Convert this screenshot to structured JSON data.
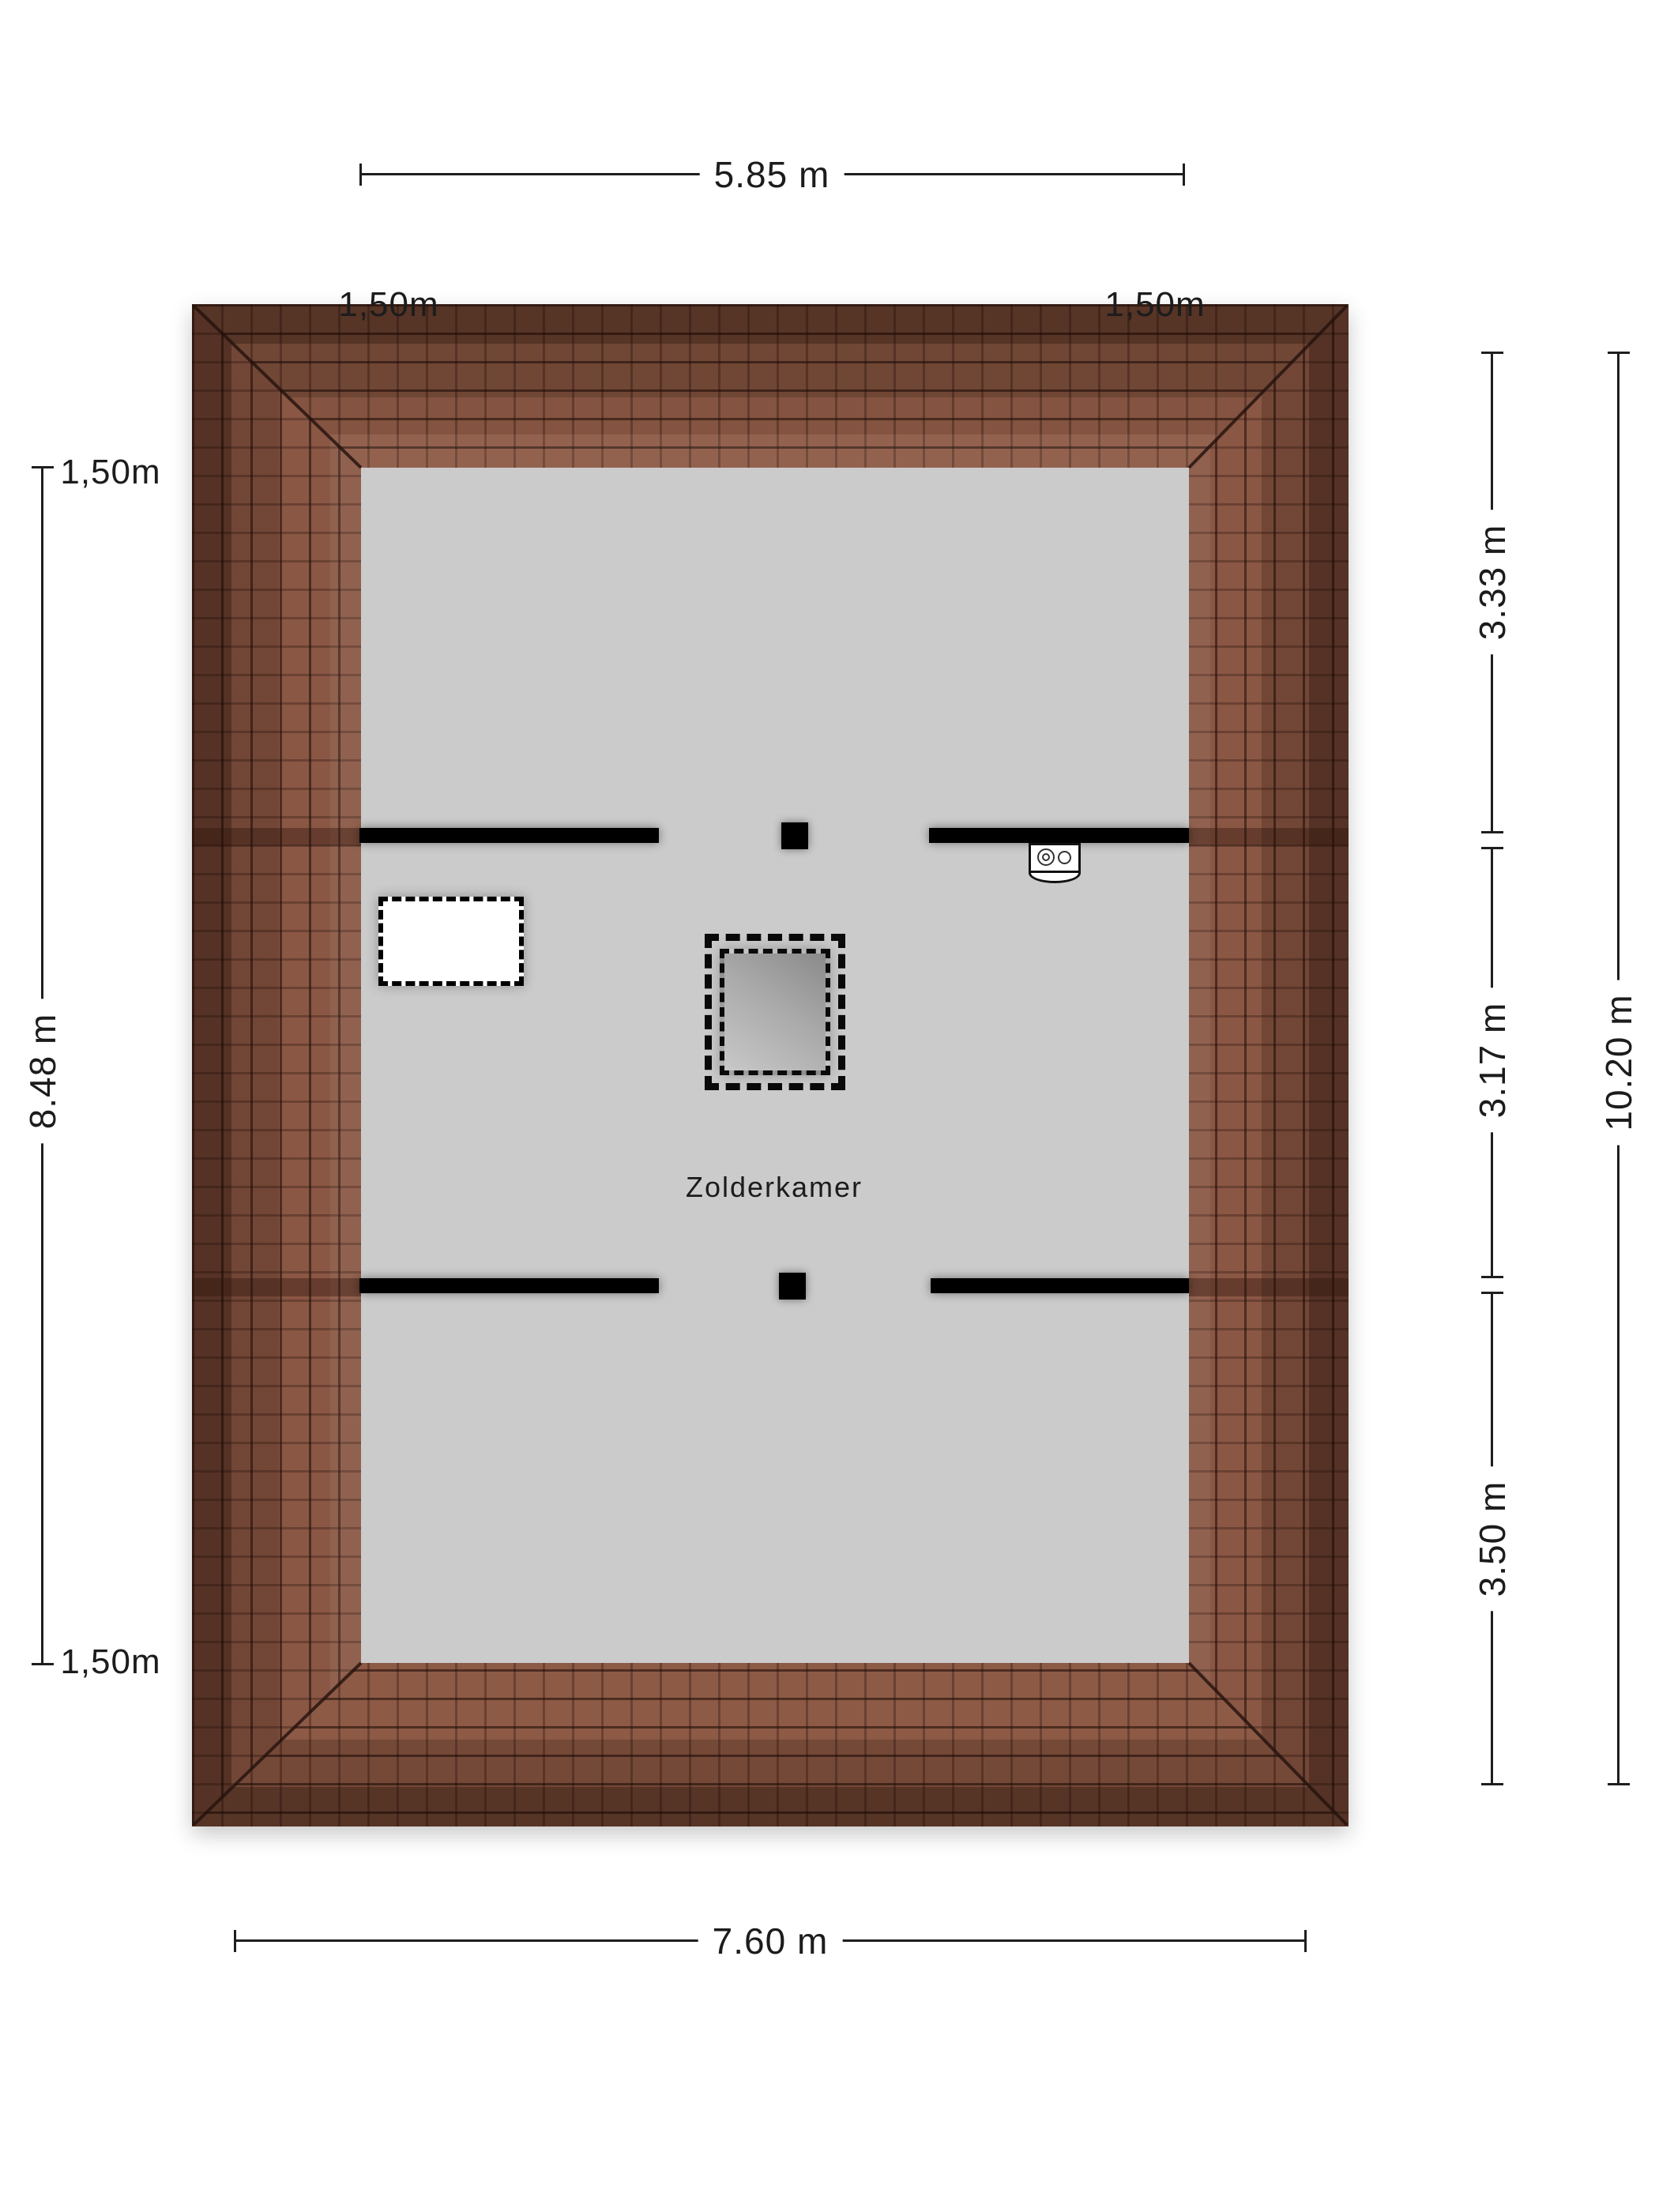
{
  "plan": {
    "type": "attic-floorplan",
    "room_label": "Zolderkamer"
  },
  "dimensions": {
    "top_width": "5.85 m",
    "overhang_top_left": "1,50m",
    "overhang_top_right": "1,50m",
    "overhang_left_top": "1,50m",
    "left_height": "8.48 m",
    "overhang_left_bottom": "1,50m",
    "right_segment_top": "3.33 m",
    "right_segment_middle": "3.17 m",
    "right_segment_bottom": "3.50 m",
    "right_total_height": "10.20 m",
    "bottom_width": "7.60 m"
  },
  "icons": {
    "boiler_unit": "cv-boiler-icon",
    "stair_opening": "dashed-stair-opening",
    "skylight": "dashed-roof-window"
  },
  "colors": {
    "roof_tile_base": "#8d5a46",
    "roof_eave_dark": "#4a2b20",
    "roof_grout": "#2e1a12",
    "room_fill": "#cbcbcb",
    "wall_fill": "#000000",
    "dimension_line": "#1e1e1e",
    "page_background": "#ffffff"
  }
}
